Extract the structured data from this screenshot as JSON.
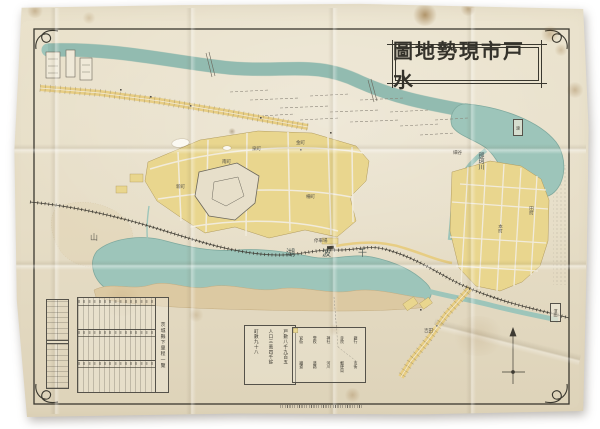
{
  "title_box": {
    "text": "圖地勢現市戸水"
  },
  "labels": {
    "lake": "湖波千",
    "river": "那珂川",
    "mountain": "山",
    "station": "停車場",
    "ferry": "渡",
    "hamlet_box": "濱田",
    "micro": {
      "m1": "本町",
      "m2": "泉町",
      "m3": "南町",
      "m4": "金町",
      "m5": "田町",
      "m6": "新町",
      "m7": "柵町",
      "m8": "細谷",
      "m9": "吉田"
    }
  },
  "stats_box": {
    "l1": "戸數八千九百五",
    "l2": "人口三萬四千餘",
    "l3": "町數九十八"
  },
  "tables": {
    "wide_caption": "茨城縣下里程一覽"
  },
  "legend": {
    "items": [
      {
        "label": "官衙",
        "color": "#c87e40"
      },
      {
        "label": "學校",
        "color": "#e8d48a"
      },
      {
        "label": "神社",
        "color": "#8fc0b6"
      },
      {
        "label": "寺院",
        "color": "#efe8d6"
      },
      {
        "label": "銀行",
        "color": "#8d8778"
      },
      {
        "label": "鐵道",
        "color": "#45423a"
      },
      {
        "label": "道路",
        "color": "#e8cf86"
      },
      {
        "label": "河川",
        "color": "#9dc5ba"
      },
      {
        "label": "郵便局",
        "color": "#5a574c"
      },
      {
        "label": "市街",
        "color": "#ead892"
      }
    ]
  },
  "colors": {
    "paper": "#e6ddc6",
    "water": "#9dc5ba",
    "blocks": "#ead892",
    "ink": "#45423a",
    "frame": "#3a382f"
  }
}
